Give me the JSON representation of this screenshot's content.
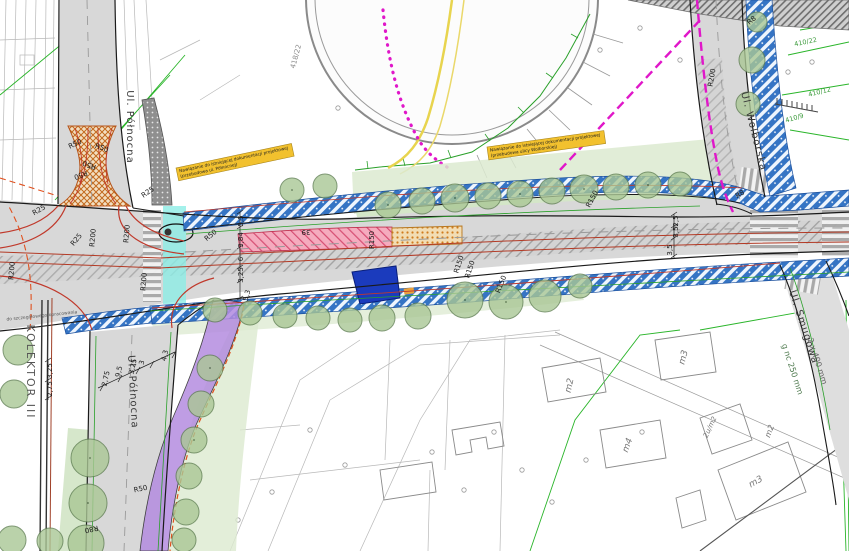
{
  "drawing": {
    "street_labels": [
      {
        "t": "Ul. Północna",
        "x": 127,
        "y": 127,
        "r": 90,
        "s": 10,
        "c": "#3a3a3a",
        "ls": 1
      },
      {
        "t": "Ul. Północna",
        "x": 130,
        "y": 392,
        "r": 87,
        "s": 10,
        "c": "#3a3a3a",
        "ls": 1
      },
      {
        "t": "Ul. Wolborska",
        "x": 751,
        "y": 132,
        "r": 76,
        "s": 10,
        "c": "#3a3a3a",
        "ls": 1
      },
      {
        "t": "Ul. Smugowa",
        "x": 801,
        "y": 328,
        "r": 72,
        "s": 10,
        "c": "#3a3a3a",
        "ls": 1
      },
      {
        "t": "KOLEKTOR III",
        "x": 27,
        "y": 372,
        "r": 90,
        "s": 11,
        "c": "#555555",
        "ls": 2
      }
    ],
    "radius_labels": [
      {
        "t": "R50",
        "x": 76,
        "y": 146,
        "r": -25
      },
      {
        "t": "R50",
        "x": 101,
        "y": 150,
        "r": 20
      },
      {
        "t": "R50",
        "x": 90,
        "y": 163,
        "r": 200
      },
      {
        "t": "R50",
        "x": 80,
        "y": 173,
        "r": 160
      },
      {
        "t": "R25",
        "x": 149,
        "y": 194,
        "r": -35
      },
      {
        "t": "R25",
        "x": 40,
        "y": 212,
        "r": -30
      },
      {
        "t": "R25",
        "x": 78,
        "y": 241,
        "r": -50
      },
      {
        "t": "R200",
        "x": 95,
        "y": 238,
        "r": -85
      },
      {
        "t": "R200",
        "x": 129,
        "y": 234,
        "r": -85
      },
      {
        "t": "R200",
        "x": 146,
        "y": 282,
        "r": -85
      },
      {
        "t": "R200",
        "x": 14,
        "y": 271,
        "r": -85
      },
      {
        "t": "R200",
        "x": 714,
        "y": 78,
        "r": -80
      },
      {
        "t": "R150",
        "x": 374,
        "y": 240,
        "r": -90
      },
      {
        "t": "R150",
        "x": 461,
        "y": 265,
        "r": -72
      },
      {
        "t": "R150",
        "x": 472,
        "y": 270,
        "r": -72
      },
      {
        "t": "R150",
        "x": 503,
        "y": 285,
        "r": -68
      },
      {
        "t": "R150",
        "x": 594,
        "y": 200,
        "r": -62
      },
      {
        "t": "R50",
        "x": 212,
        "y": 237,
        "r": -40
      },
      {
        "t": "R8",
        "x": 753,
        "y": 22,
        "r": -40
      },
      {
        "t": "R8",
        "x": 741,
        "y": 196,
        "r": -30
      },
      {
        "t": "R80",
        "x": 91,
        "y": 527,
        "r": 168
      },
      {
        "t": "R50",
        "x": 141,
        "y": 491,
        "r": -12
      }
    ],
    "dimension_labels": [
      {
        "t": "5,5",
        "x": 243,
        "y": 221,
        "r": -90
      },
      {
        "t": "3,84",
        "x": 243,
        "y": 240,
        "r": -90
      },
      {
        "t": "6",
        "x": 243,
        "y": 259,
        "r": -90
      },
      {
        "t": "3,25",
        "x": 243,
        "y": 275,
        "r": -90
      },
      {
        "t": "5,3",
        "x": 249,
        "y": 296,
        "r": -75
      },
      {
        "t": "39",
        "x": 306,
        "y": 230,
        "r": 180
      },
      {
        "t": "2,5",
        "x": 678,
        "y": 221,
        "r": -90
      },
      {
        "t": "3,5",
        "x": 678,
        "y": 232,
        "r": -90
      },
      {
        "t": "3,5",
        "x": 672,
        "y": 250,
        "r": -90
      },
      {
        "t": "2,75",
        "x": 108,
        "y": 379,
        "r": -78
      },
      {
        "t": "9,5",
        "x": 121,
        "y": 372,
        "r": -78
      },
      {
        "t": "3,25",
        "x": 135,
        "y": 367,
        "r": -78
      },
      {
        "t": "3",
        "x": 144,
        "y": 363,
        "r": -78
      },
      {
        "t": "4,3",
        "x": 167,
        "y": 356,
        "r": -78
      },
      {
        "t": "3,25",
        "x": 52,
        "y": 371,
        "r": -90
      },
      {
        "t": "2,75",
        "x": 52,
        "y": 389,
        "r": -90
      }
    ],
    "parcel_labels": [
      {
        "t": "418/22",
        "x": 298,
        "y": 57,
        "r": -75,
        "s": 7,
        "c": "#8a8a8a"
      },
      {
        "t": "410/22",
        "x": 806,
        "y": 44,
        "r": -12,
        "s": 6.5,
        "c": "#3a9a3a"
      },
      {
        "t": "410/12",
        "x": 820,
        "y": 94,
        "r": -14,
        "s": 6.5,
        "c": "#3a9a3a"
      },
      {
        "t": "410/9",
        "x": 795,
        "y": 120,
        "r": -16,
        "s": 6.5,
        "c": "#3a9a3a"
      }
    ],
    "building_labels": [
      {
        "t": "m2",
        "x": 572,
        "y": 386,
        "r": -78,
        "s": 9,
        "c": "#777777",
        "i": 1
      },
      {
        "t": "m3",
        "x": 686,
        "y": 358,
        "r": -75,
        "s": 9,
        "c": "#777777",
        "i": 1
      },
      {
        "t": "m4",
        "x": 630,
        "y": 446,
        "r": -70,
        "s": 9,
        "c": "#777777",
        "i": 1
      },
      {
        "t": "m3",
        "x": 757,
        "y": 484,
        "r": -30,
        "s": 9,
        "c": "#777777",
        "i": 1
      },
      {
        "t": "2u/m2",
        "x": 712,
        "y": 428,
        "r": -65,
        "s": 7,
        "c": "#777777",
        "i": 1
      },
      {
        "t": "m2",
        "x": 772,
        "y": 432,
        "r": -70,
        "s": 8,
        "c": "#777777",
        "i": 1
      }
    ],
    "misc_labels": [
      {
        "t": "2 x 400 mm",
        "x": 815,
        "y": 362,
        "r": 72,
        "s": 8,
        "c": "#666666"
      },
      {
        "t": "g nc 250 mm",
        "x": 790,
        "y": 370,
        "r": 72,
        "s": 8,
        "c": "#4f7a4f"
      },
      {
        "t": "do szczegółowego opracowania",
        "x": 42,
        "y": 317,
        "r": -6,
        "s": 4.5,
        "c": "#555555"
      }
    ],
    "notes": [
      {
        "l1": "Nawiązanie do istniejącej dokumentacji projektowej",
        "l2": "(przebudowa ul. Północnej)",
        "x": 176,
        "y": 168,
        "r": -12,
        "w": 118
      },
      {
        "l1": "Nawiązanie do istniejącej dokumentacji projektowej",
        "l2": "(przebudowa ulicy Wolborskiej)",
        "x": 487,
        "y": 147,
        "r": -8,
        "w": 118
      }
    ],
    "colors": {
      "road_gray": "#d8d8d8",
      "bike_band_blue": "#3574c4",
      "greenery": "#cfe3c2",
      "tree_green": "#aac795",
      "new_pavement_pink": "#f5abbe",
      "median_island_tan": "#f2ddb4",
      "ramp_hatch_orange": "#c26a1e",
      "path_purple": "#b48ce0",
      "crossing_cyan": "#8deee6",
      "structure_navy": "#1b3bbd",
      "boundary_magenta": "#e017c9",
      "curve_red": "#c0392b",
      "note_yellow": "#f2c12e",
      "cadastral_green": "#2ab52a",
      "utility_yellow": "#e8d44e"
    }
  }
}
